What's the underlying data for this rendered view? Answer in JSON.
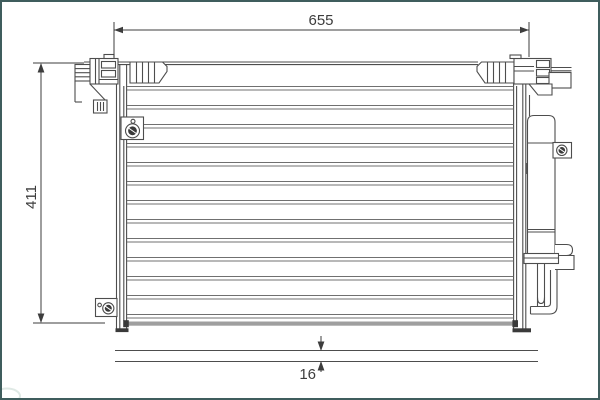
{
  "colors": {
    "frame": "#3f5d5d",
    "background": "#ffffff",
    "line": "#4d4d4d",
    "fin": "#707070",
    "band": "#9f9f9f",
    "dim": "#3d3d3d",
    "dark": "#3a3a3a",
    "watermark": "#dfe9e5"
  },
  "diagram": {
    "subject": "ac-condenser-with-receiver-drier",
    "labels": {
      "overall_width": "655",
      "overall_height": "411",
      "core_depth": "16"
    }
  }
}
